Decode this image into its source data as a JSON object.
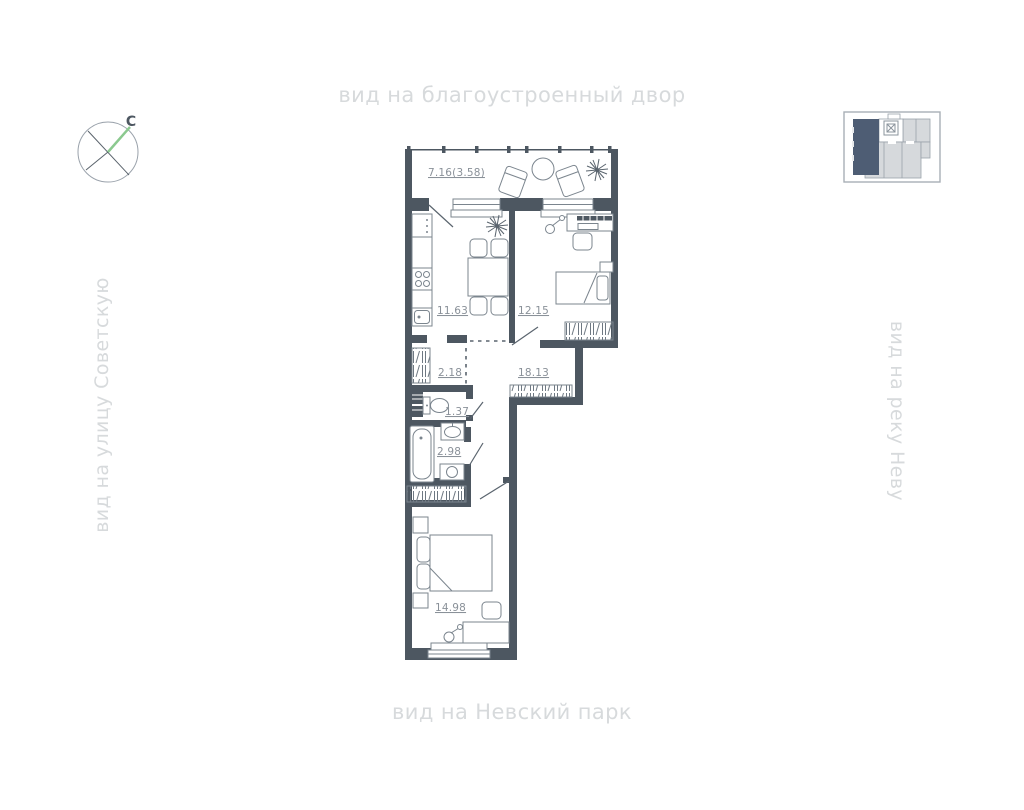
{
  "captions": {
    "top": "вид на благоустроенный двор",
    "bottom": "вид на Невский парк",
    "left": "вид на улицу Советскую",
    "right": "вид на реку Неву"
  },
  "compass": {
    "north_label": "С",
    "needle_color": "#8bc98f"
  },
  "plan": {
    "wall_color": "#4d5761",
    "label_color": "#8a9199",
    "rooms": [
      {
        "name": "balcony",
        "area": "7.16(3.58)"
      },
      {
        "name": "kitchen",
        "area": "11.63"
      },
      {
        "name": "bedroom",
        "area": "12.15"
      },
      {
        "name": "closet",
        "area": "2.18"
      },
      {
        "name": "hallway",
        "area": "18.13"
      },
      {
        "name": "wc",
        "area": "1.37"
      },
      {
        "name": "bathroom",
        "area": "2.98"
      },
      {
        "name": "bedroom-2",
        "area": "14.98"
      }
    ]
  },
  "minimap": {
    "highlight_color": "#4e5d74",
    "unit_color": "#d6d9dc"
  }
}
